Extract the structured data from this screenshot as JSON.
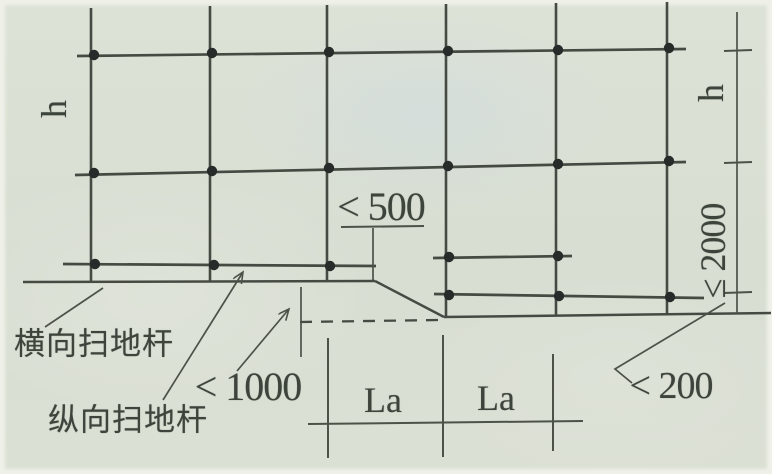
{
  "diagram": {
    "description_labels": {
      "transverse_sweep_rod": "横向扫地杆",
      "longitudinal_sweep_rod": "纵向扫地杆"
    },
    "dimension_labels": {
      "step_edge_to_pole": "< 500",
      "ground_level_difference": "< 1000",
      "pole_to_edge": "< 200",
      "max_bottom_lift": "≤ 2000",
      "story_height_left": "h",
      "story_height_right": "h",
      "span_left": "La",
      "span_right": "La"
    },
    "colors": {
      "paper": "#d9dfd3",
      "ink_line": "#454b42",
      "ink_thin": "#4c5248",
      "ink_dot": "#272b29",
      "ink_text": "#3d443c"
    }
  }
}
